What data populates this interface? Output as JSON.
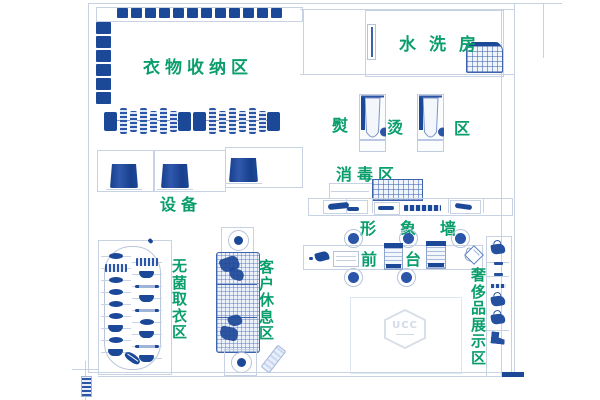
{
  "colors": {
    "navy": "#1c4898",
    "sketch_blue": "#3d63ae",
    "wall_line": "#c7d2e2",
    "label_green": "#0a9e6d",
    "logo_gray": "#d3dae6"
  },
  "labels": {
    "clothing_storage_area": "衣物收纳区",
    "equipment": "设备",
    "washing_room": "水洗房",
    "ironing_chars": [
      "熨",
      "烫",
      "区"
    ],
    "disinfection_area": "消毒区",
    "image_wall": "形象墙",
    "front_desk": "前台",
    "sterile_pickup_area": "无菌取衣区",
    "customer_rest_area": "客户休息区",
    "luxury_display_area": "奢侈品展示区",
    "brand_logo": "UCC"
  },
  "decor": {
    "top_shelf_boxes": 12,
    "left_shelf_boxes": 6,
    "rail1_hangers": 6,
    "rail2_hangers": 6,
    "conveyor_left_items": [
      "eye",
      "stripes",
      "eye",
      "eye",
      "eye",
      "eye",
      "bowl",
      "eye",
      "bowl"
    ],
    "conveyor_right_items": [
      "stripes",
      "bowl",
      "line",
      "bowl",
      "line",
      "eye",
      "bowl",
      "line",
      "bowl"
    ],
    "display_items": [
      "bag",
      "tick",
      "tick",
      "bar",
      "bag",
      "bag",
      "boot"
    ]
  }
}
